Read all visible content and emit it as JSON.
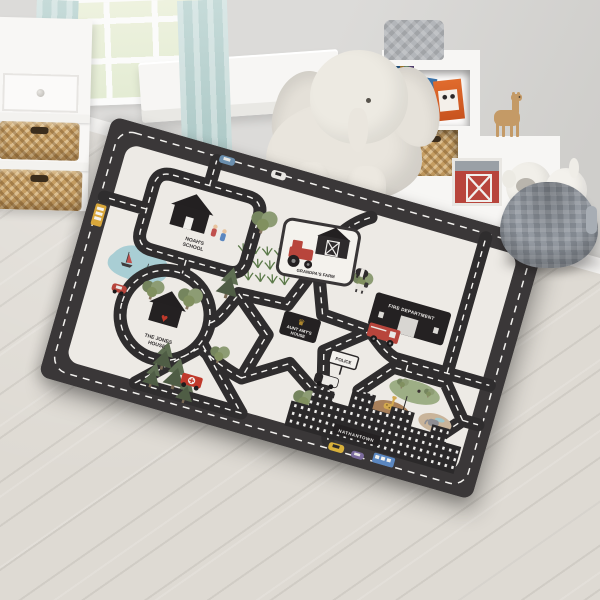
{
  "rug": {
    "labels": {
      "school_line1": "NOAH'S",
      "school_line2": "SCHOOL",
      "farm": "GRANDPA'S FARM",
      "jones_house_line1": "THE JONES",
      "jones_house_line2": "HOUSE",
      "star_house_line1": "AUNT AMY'S",
      "star_house_line2": "HOUSE",
      "fire_department": "FIRE DEPARTMENT",
      "police": "POLICE",
      "zoo": "ZOO",
      "town": "NATHANTOWN"
    },
    "icons": {
      "heart": "♥",
      "crown": "♛"
    },
    "colors": {
      "rug_border": "#3a3738",
      "rug_mat": "#edeae5",
      "road": "#2f2d2e",
      "accent_red": "#b8453c",
      "tree_green": "#8d9c74",
      "lake_blue": "#a9ced4",
      "crown_gold": "#d9a832"
    }
  },
  "room": {
    "colors": {
      "wall": "#d7d6d4",
      "floor": "#d9d5ce",
      "curtains": "#b9d4d2",
      "baskets": "#c59d62",
      "pouf": "#8f959c"
    }
  }
}
